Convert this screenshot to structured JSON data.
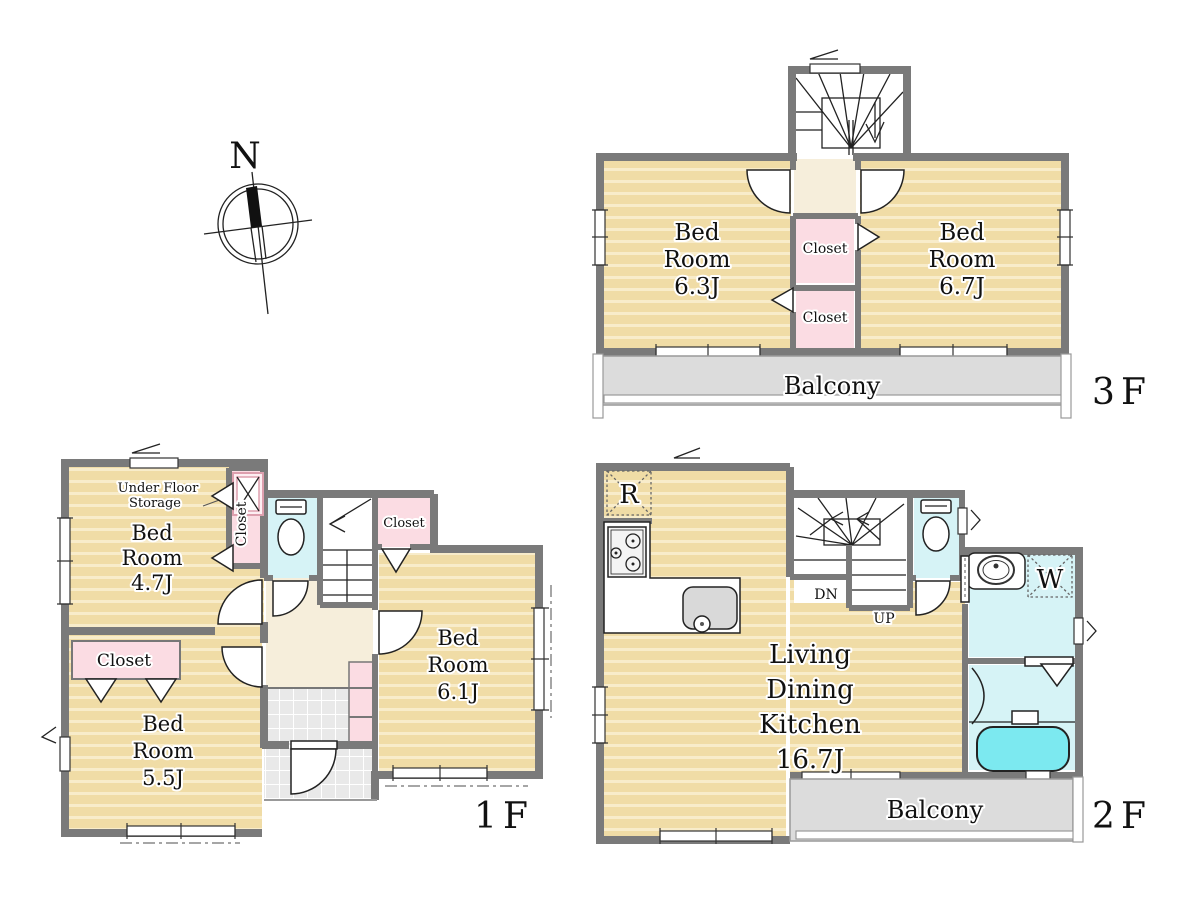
{
  "colors": {
    "wall": "#7a7a7a",
    "floor": "#f0dca6",
    "floor_stripe": "#f8ecca",
    "closet": "#fbdce3",
    "wet": "#d6f3f6",
    "tub": "#7ce9f0",
    "hall": "#f6eedb",
    "balcony": "#dcdcdc",
    "tile": "#e9e9e9"
  },
  "compass": {
    "north_label": "N"
  },
  "floor3": {
    "label": "3F",
    "bed63": {
      "line1": "Bed",
      "line2": "Room",
      "size": "6.3J"
    },
    "bed67": {
      "line1": "Bed",
      "line2": "Room",
      "size": "6.7J"
    },
    "closet_upper": "Closet",
    "closet_lower": "Closet",
    "balcony": "Balcony"
  },
  "floor2": {
    "label": "2F",
    "ldk": {
      "line1": "Living",
      "line2": "Dining",
      "line3": "Kitchen",
      "size": "16.7J"
    },
    "refrigerator": "R",
    "washer": "W",
    "down": "DN",
    "up": "UP",
    "balcony": "Balcony"
  },
  "floor1": {
    "label": "1F",
    "bed47": {
      "line1": "Bed",
      "line2": "Room",
      "size": "4.7J"
    },
    "bed55": {
      "line1": "Bed",
      "line2": "Room",
      "size": "5.5J"
    },
    "bed61": {
      "line1": "Bed",
      "line2": "Room",
      "size": "6.1J"
    },
    "under_floor": {
      "line1": "Under Floor",
      "line2": "Storage"
    },
    "closet_wic": "Closet",
    "closet_61": "Closet",
    "closet_55": "Closet"
  }
}
